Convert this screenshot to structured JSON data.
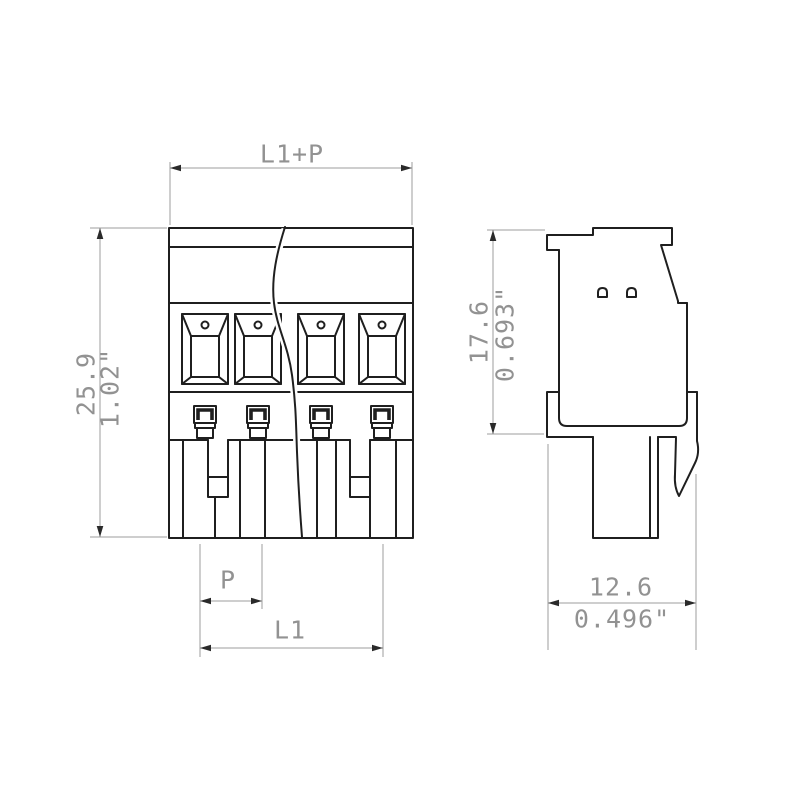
{
  "labels": {
    "overall_width": "L1+P",
    "overall_height_mm": "25.9",
    "overall_height_in": "1.02\"",
    "pitch": "P",
    "length": "L1",
    "side_height_mm": "17.6",
    "side_height_in": "0.693\"",
    "side_width_mm": "12.6",
    "side_width_in": "0.496\""
  },
  "colors": {
    "background": "#ffffff",
    "part_outline": "#1f1f1f",
    "dimension_lines": "#9c9c9c",
    "dimension_text": "#929292"
  }
}
